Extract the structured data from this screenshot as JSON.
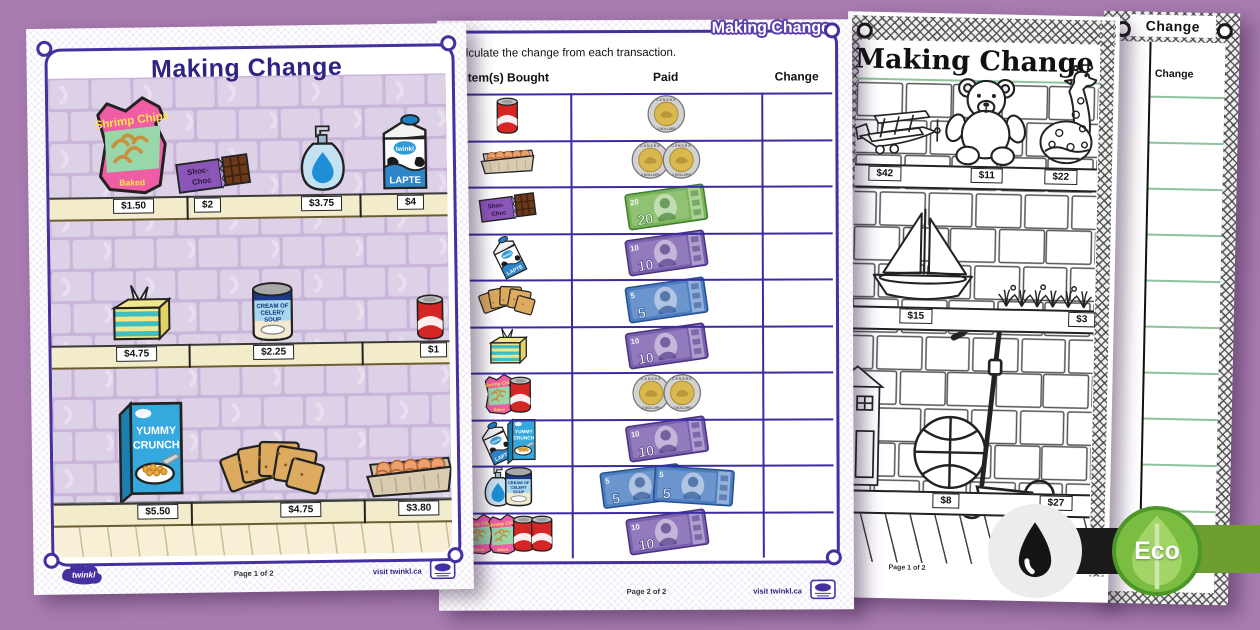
{
  "background_color": "#a87cb0",
  "accent_color": "#4630a0",
  "page1": {
    "title": "Making Change",
    "shelves": [
      {
        "items": [
          {
            "name": "Shrimp Chips bag",
            "price": "$1.50"
          },
          {
            "name": "Shoc-Choc chocolate bar",
            "price": "$2"
          },
          {
            "name": "Soap dispenser",
            "price": "$3.75"
          },
          {
            "name": "Milk carton",
            "price": "$4"
          }
        ]
      },
      {
        "items": [
          {
            "name": "Tissue box",
            "price": "$4.75"
          },
          {
            "name": "Cream of Celery Soup can",
            "price": "$2.25"
          },
          {
            "name": "Soda can",
            "price": "$1"
          }
        ]
      },
      {
        "items": [
          {
            "name": "Yummy Crunch cereal box",
            "price": "$5.50"
          },
          {
            "name": "Crackers",
            "price": "$4.75"
          },
          {
            "name": "Carton of eggs",
            "price": "$3.80"
          }
        ]
      }
    ],
    "footer": {
      "logo": "twinkl",
      "page": "Page 1 of 2",
      "visit": "visit twinkl.ca"
    }
  },
  "icon_labels": {
    "chips_title": "Shrimp Chips",
    "chips_sub": "Baked",
    "choc_line1": "Shoc-",
    "choc_line2": "Choc",
    "milk_label": "LAPTE",
    "milk_brand": "twinkl",
    "soup_line1": "CREAM OF",
    "soup_line2": "CELERY",
    "soup_line3": "SOUP",
    "cereal_line1": "YUMMY",
    "cereal_line2": "CRUNCH",
    "coin_top": "CANADA",
    "coin_bottom": "2 DOLLARS",
    "bill_5": "5",
    "bill_10": "10",
    "bill_20": "20"
  },
  "page2": {
    "title": "Making Change",
    "instruction": "Calculate the change from each transaction.",
    "columns": [
      "Item(s) Bought",
      "Paid",
      "Change"
    ],
    "rows": [
      {
        "items": [
          "soda-can"
        ],
        "paid": [
          "toonie"
        ]
      },
      {
        "items": [
          "eggs"
        ],
        "paid": [
          "toonie",
          "toonie"
        ]
      },
      {
        "items": [
          "chocolate-bar"
        ],
        "paid": [
          "bill-20"
        ]
      },
      {
        "items": [
          "milk"
        ],
        "paid": [
          "bill-10"
        ]
      },
      {
        "items": [
          "crackers"
        ],
        "paid": [
          "bill-5"
        ]
      },
      {
        "items": [
          "tissues"
        ],
        "paid": [
          "bill-10"
        ]
      },
      {
        "items": [
          "shrimp-chips",
          "soda-can"
        ],
        "paid": [
          "toonie",
          "toonie"
        ]
      },
      {
        "items": [
          "milk",
          "cereal"
        ],
        "paid": [
          "bill-10"
        ]
      },
      {
        "items": [
          "soap",
          "soup"
        ],
        "paid": [
          "bill-5",
          "bill-5"
        ]
      },
      {
        "items": [
          "shrimp-chips",
          "shrimp-chips",
          "soda-can",
          "soda-can"
        ],
        "paid": [
          "bill-10"
        ]
      }
    ],
    "footer": {
      "page": "Page 2 of 2",
      "visit": "visit twinkl.ca"
    }
  },
  "page3": {
    "title": "Making Change",
    "shelves": [
      {
        "items": [
          {
            "name": "Biplane",
            "price": "$42"
          },
          {
            "name": "Teddy bear",
            "price": "$11"
          },
          {
            "name": "Giraffe",
            "price": "$22"
          }
        ]
      },
      {
        "items": [
          {
            "name": "Sailboat",
            "price": "$15"
          },
          {
            "name": "Plants",
            "price": "$3"
          }
        ]
      },
      {
        "items": [
          {
            "name": "Dollhouse",
            "price": ""
          },
          {
            "name": "Basketball",
            "price": "$8"
          },
          {
            "name": "Scooter",
            "price": "$27"
          }
        ]
      }
    ],
    "footer": {
      "page": "Page 1 of 2"
    }
  },
  "page4": {
    "title": "Change",
    "column": "Change"
  },
  "badges": {
    "eco_label": "Eco",
    "ink_color": "#141414",
    "eco_color": "#7abd41"
  }
}
